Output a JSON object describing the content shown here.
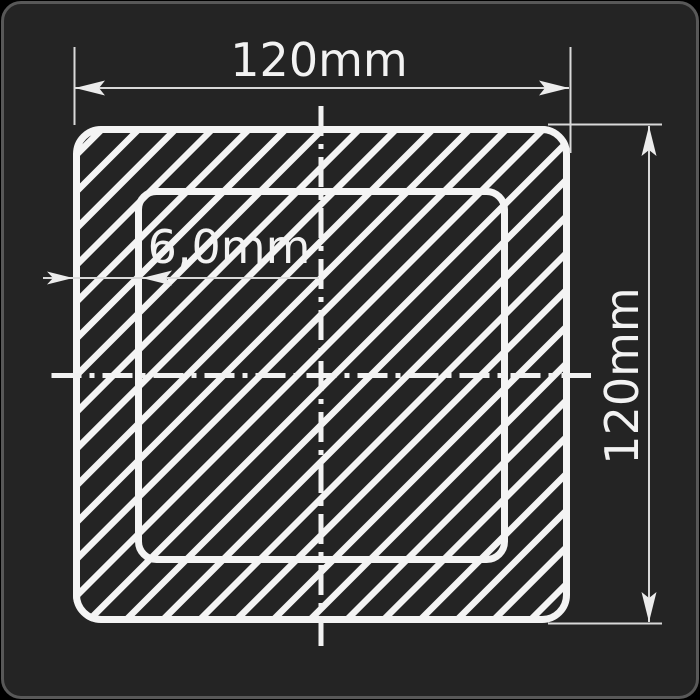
{
  "drawing": {
    "kind": "technical-cross-section",
    "shape": "square hollow tube profile",
    "labels": {
      "width": "120mm",
      "height": "120mm",
      "wall_thickness": "6,0mm"
    },
    "colors": {
      "background": "#242424",
      "panel_border": "#585858",
      "outline_stroke": "#f4f4f4",
      "dimension_line": "#d9d9d9",
      "center_line": "#f2f2f2",
      "text": "#f2f2f2"
    }
  }
}
